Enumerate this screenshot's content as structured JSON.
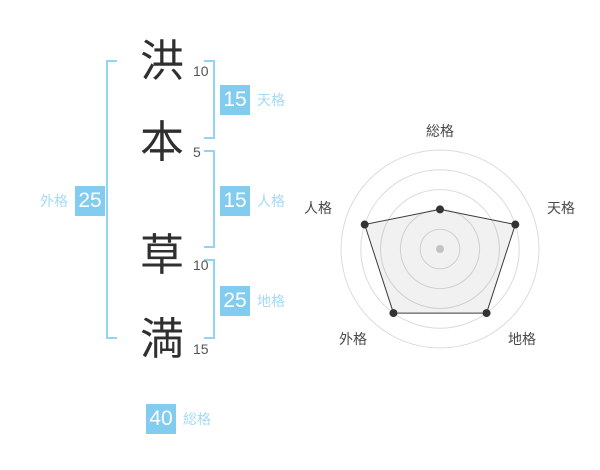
{
  "name_diagram": {
    "characters": [
      {
        "char": "洪",
        "strokes": "10"
      },
      {
        "char": "本",
        "strokes": "5"
      },
      {
        "char": "草",
        "strokes": "10"
      },
      {
        "char": "満",
        "strokes": "15"
      }
    ],
    "badges": {
      "tenkaku": {
        "value": "15",
        "label": "天格"
      },
      "jinkaku": {
        "value": "15",
        "label": "人格"
      },
      "chikaku": {
        "value": "25",
        "label": "地格"
      },
      "gaikaku": {
        "value": "25",
        "label": "外格"
      },
      "soukaku": {
        "value": "40",
        "label": "総格"
      }
    },
    "colors": {
      "badge_bg": "#82ccf0",
      "badge_text": "#ffffff",
      "label_text": "#a6daf5",
      "bracket": "#90d5f5",
      "kanji": "#2f2f2f",
      "strokes": "#555555"
    }
  },
  "chart_data": {
    "type": "radar",
    "axes": [
      "総格",
      "天格",
      "地格",
      "外格",
      "人格"
    ],
    "values": [
      2,
      4,
      4,
      4,
      4
    ],
    "max": 5,
    "rings": 5,
    "start_angle_deg": -90,
    "grid": "circular",
    "legend_position": "none",
    "label_positions": [
      [
        140,
        31
      ],
      [
        261,
        108
      ],
      [
        222,
        239
      ],
      [
        53,
        239
      ],
      [
        18,
        108
      ]
    ],
    "colors": {
      "grid": "#dcdcdc",
      "center_dot": "#c4c4c4",
      "fill": "rgba(0,0,0,0.055)",
      "stroke": "#3b3b3b",
      "point": "#333333",
      "label": "#4a4a4a"
    }
  }
}
